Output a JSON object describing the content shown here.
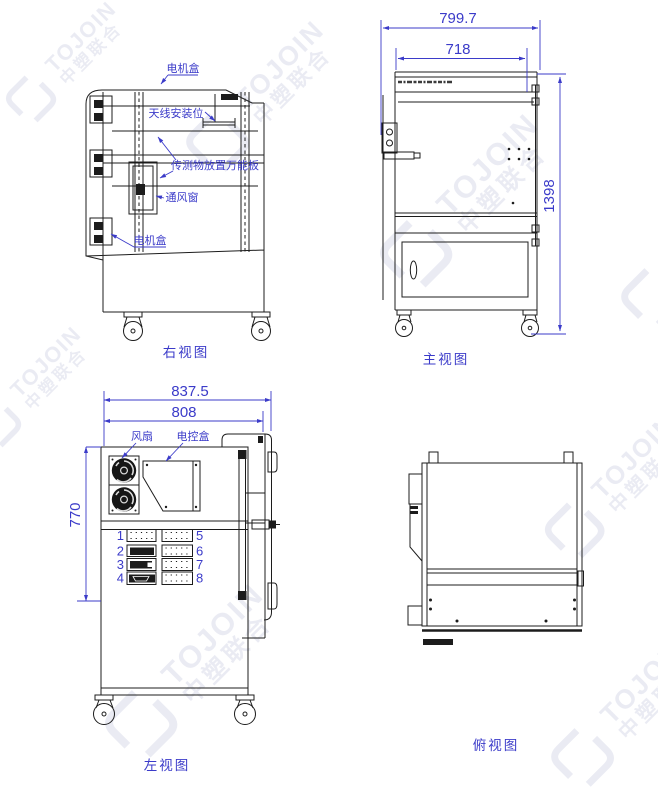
{
  "drawing": {
    "watermark": {
      "brand": "TOJOIN",
      "brand_cn": "中塑联合"
    },
    "colors": {
      "dimension_blue": "#3b3bc9",
      "line_black": "#1c1c1c",
      "watermark": "#666fa8"
    },
    "views": {
      "right": {
        "label": "右视图",
        "callouts": {
          "motor_box_top": "电机盒",
          "antenna_mount": "天线安装位",
          "universal_board": "传测物放置万能板",
          "vent_window": "通风窗",
          "motor_box_bottom": "电机盒"
        }
      },
      "front": {
        "label": "主视图",
        "dims": {
          "overall_width": "799.7",
          "inner_width": "718",
          "overall_height": "1398"
        }
      },
      "left": {
        "label": "左视图",
        "dims": {
          "overall_width": "837.5",
          "inner_width": "808",
          "body_height": "770"
        },
        "callouts": {
          "fan": "风扇",
          "control_box": "电控盒"
        },
        "ports": [
          "1",
          "2",
          "3",
          "4",
          "5",
          "6",
          "7",
          "8"
        ]
      },
      "top": {
        "label": "俯视图"
      }
    }
  }
}
